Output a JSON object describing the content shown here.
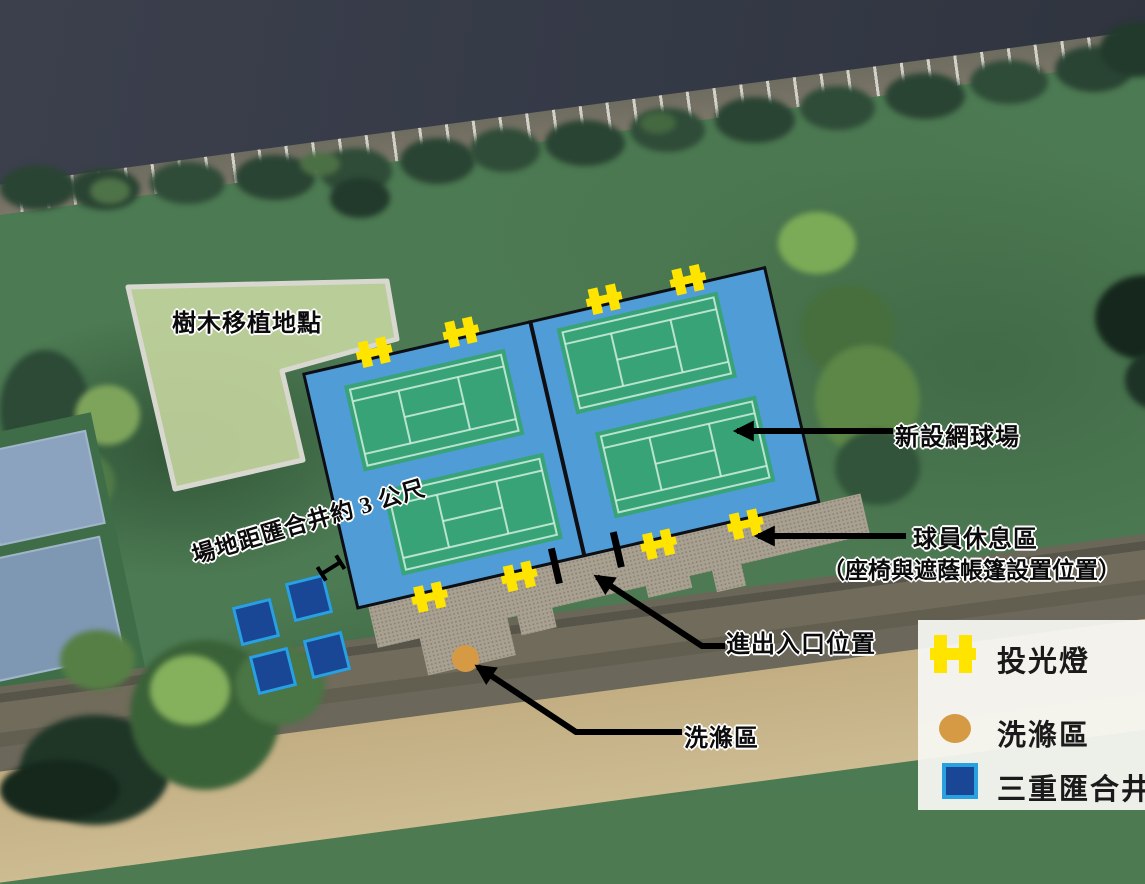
{
  "annotations": {
    "tree_area": "樹木移植地點",
    "distance_note": "場地距匯合井約 3 公尺",
    "new_court": "新設網球場",
    "rest_area_line1": "球員休息區",
    "rest_area_line2": "（座椅與遮蔭帳篷設置位置）",
    "entrance": "進出入口位置",
    "washing": "洗滌區"
  },
  "legend": {
    "floodlight_label": "投光燈",
    "washing_label": "洗滌區",
    "junction_well_label": "三重匯合井",
    "floodlight_color": "#ffe400",
    "washing_color": "#d69a45",
    "junction_well_fill": "#1a4795",
    "junction_well_border": "#29a0e0"
  },
  "site": {
    "court_fill_color": "#4f9cd6",
    "court_surface_color": "#37a377",
    "transplant_area_color": "#c8d8a2",
    "pavement_color": "#a8a090"
  }
}
